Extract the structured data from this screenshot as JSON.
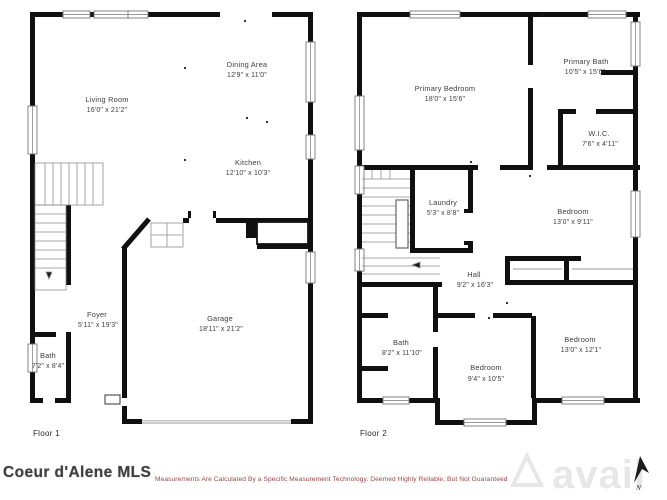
{
  "floor1": {
    "label": "Floor 1",
    "rooms": {
      "living_room": {
        "name": "Living Room",
        "dims": "16'0\" x 21'2\""
      },
      "dining_area": {
        "name": "Dining Area",
        "dims": "12'9\" x 11'0\""
      },
      "kitchen": {
        "name": "Kitchen",
        "dims": "12'10\" x 10'3\""
      },
      "foyer": {
        "name": "Foyer",
        "dims": "5'11\" x 19'3\""
      },
      "bath": {
        "name": "Bath",
        "dims": "7'2\" x 8'4\""
      },
      "garage": {
        "name": "Garage",
        "dims": "18'11\" x 21'2\""
      }
    }
  },
  "floor2": {
    "label": "Floor 2",
    "rooms": {
      "primary_bedroom": {
        "name": "Primary Bedroom",
        "dims": "18'0\" x 15'6\""
      },
      "primary_bath": {
        "name": "Primary Bath",
        "dims": "10'5\" x 15'6\""
      },
      "wic": {
        "name": "W.I.C.",
        "dims": "7'6\" x 4'11\""
      },
      "laundry": {
        "name": "Laundry",
        "dims": "5'3\" x 8'8\""
      },
      "bedroom_ne": {
        "name": "Bedroom",
        "dims": "13'0\" x 9'11\""
      },
      "hall": {
        "name": "Hall",
        "dims": "9'2\" x 16'3\""
      },
      "bath": {
        "name": "Bath",
        "dims": "8'2\" x 11'10\""
      },
      "bedroom_s": {
        "name": "Bedroom",
        "dims": "9'4\" x 10'5\""
      },
      "bedroom_se": {
        "name": "Bedroom",
        "dims": "13'0\" x 12'1\""
      }
    }
  },
  "footer": {
    "mls_name": "Coeur d'Alene MLS",
    "disclaimer": "Measurements Are Calculated By a Specific Measurement Technology. Deemed Highly Reliable, But Not Guaranteed",
    "watermark": "avail",
    "north_label": "N"
  },
  "colors": {
    "wall": "#101010",
    "label_text": "#3c3c3c",
    "disclaimer_red": "#9c4545",
    "watermark_gray": "#e7e7e7"
  }
}
